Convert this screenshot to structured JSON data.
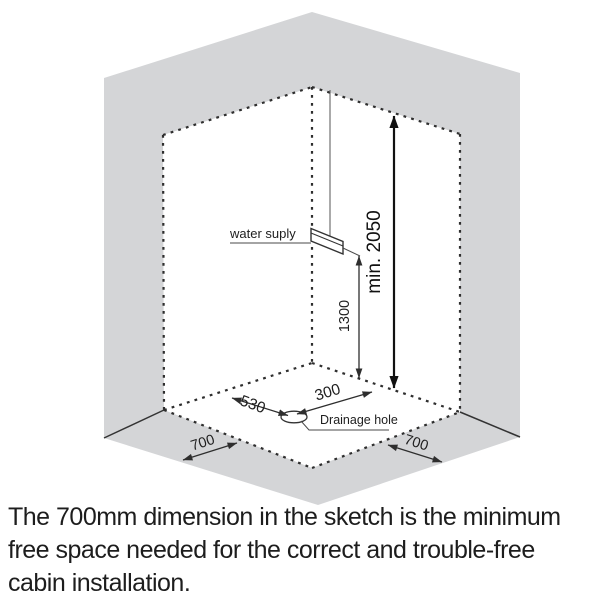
{
  "figure": {
    "labels": {
      "water_supply": "water suply",
      "drainage_hole": "Drainage hole"
    },
    "dimensions": {
      "min_height": "min. 2050",
      "supply_height": "1300",
      "drain_from_left_wall": "530",
      "drain_from_right_wall": "300",
      "left_clearance": "700",
      "right_clearance": "700"
    },
    "colors": {
      "wall_gray": "#d4d5d7",
      "outline": "#2e2e2e",
      "dim_line": "#3f3f3f",
      "label_text": "#1e1e1e"
    }
  },
  "caption": {
    "text": "The 700mm dimension in the sketch is the minimum\nfree space needed for the correct and trouble-free\ncabin installation."
  }
}
